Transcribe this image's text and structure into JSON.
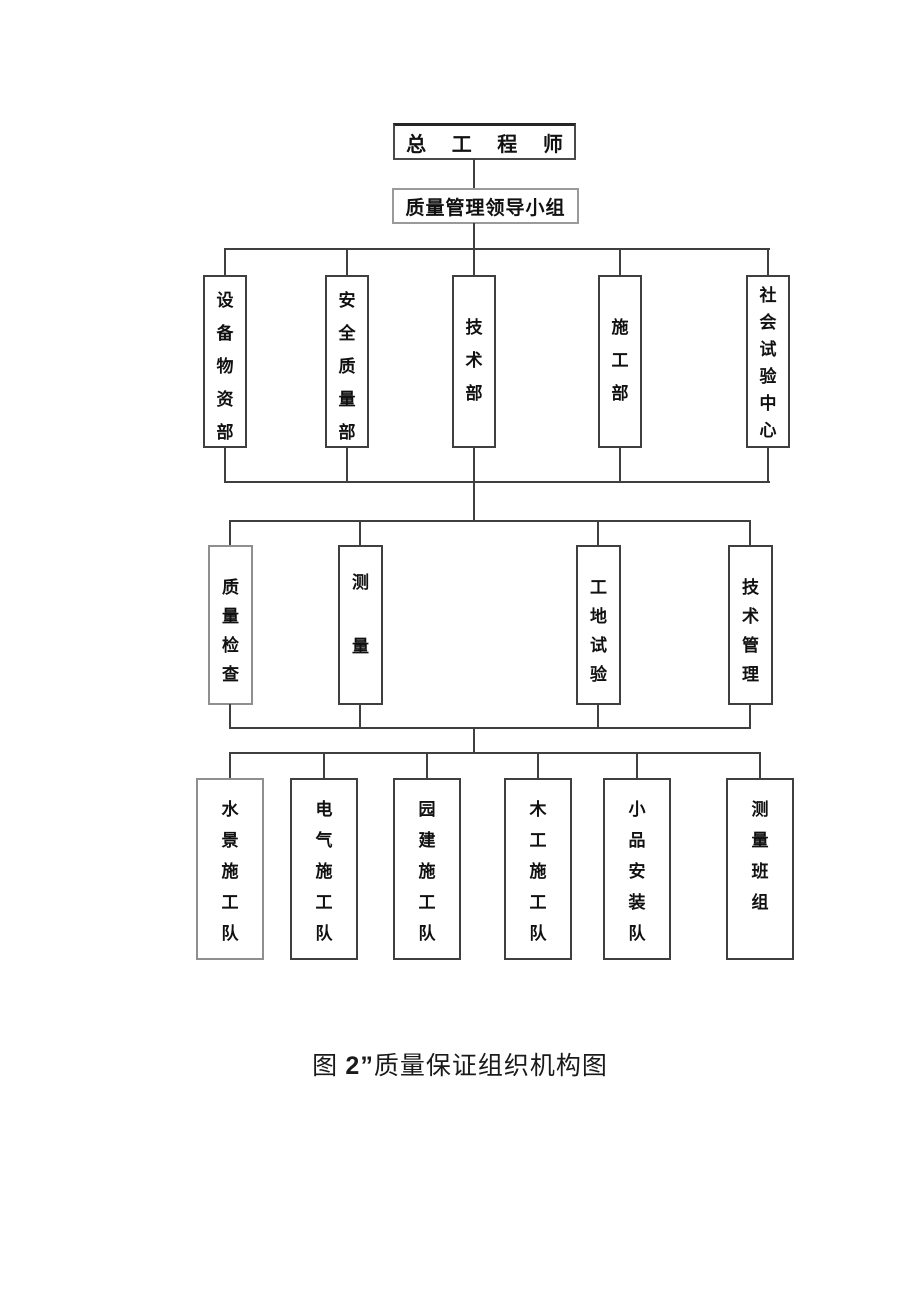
{
  "diagram": {
    "root": "总 工 程 师",
    "leadership": "质量管理领导小组",
    "departments": [
      "设备物资部",
      "安全质量部",
      "技术部",
      "施工部",
      "社会试验中心"
    ],
    "functions": [
      "质量检查",
      "测量",
      "工地试验",
      "技术管理"
    ],
    "teams": [
      "水景施工队",
      "电气施工队",
      "园建施工队",
      "木工施工队",
      "小品安装队",
      "测量班组"
    ]
  },
  "caption": {
    "figure_prefix": "图 ",
    "figure_number": "2”",
    "title": "质量保证组织机构图"
  },
  "colors": {
    "line": "#3f3f3f",
    "text": "#111111",
    "background": "#ffffff"
  }
}
